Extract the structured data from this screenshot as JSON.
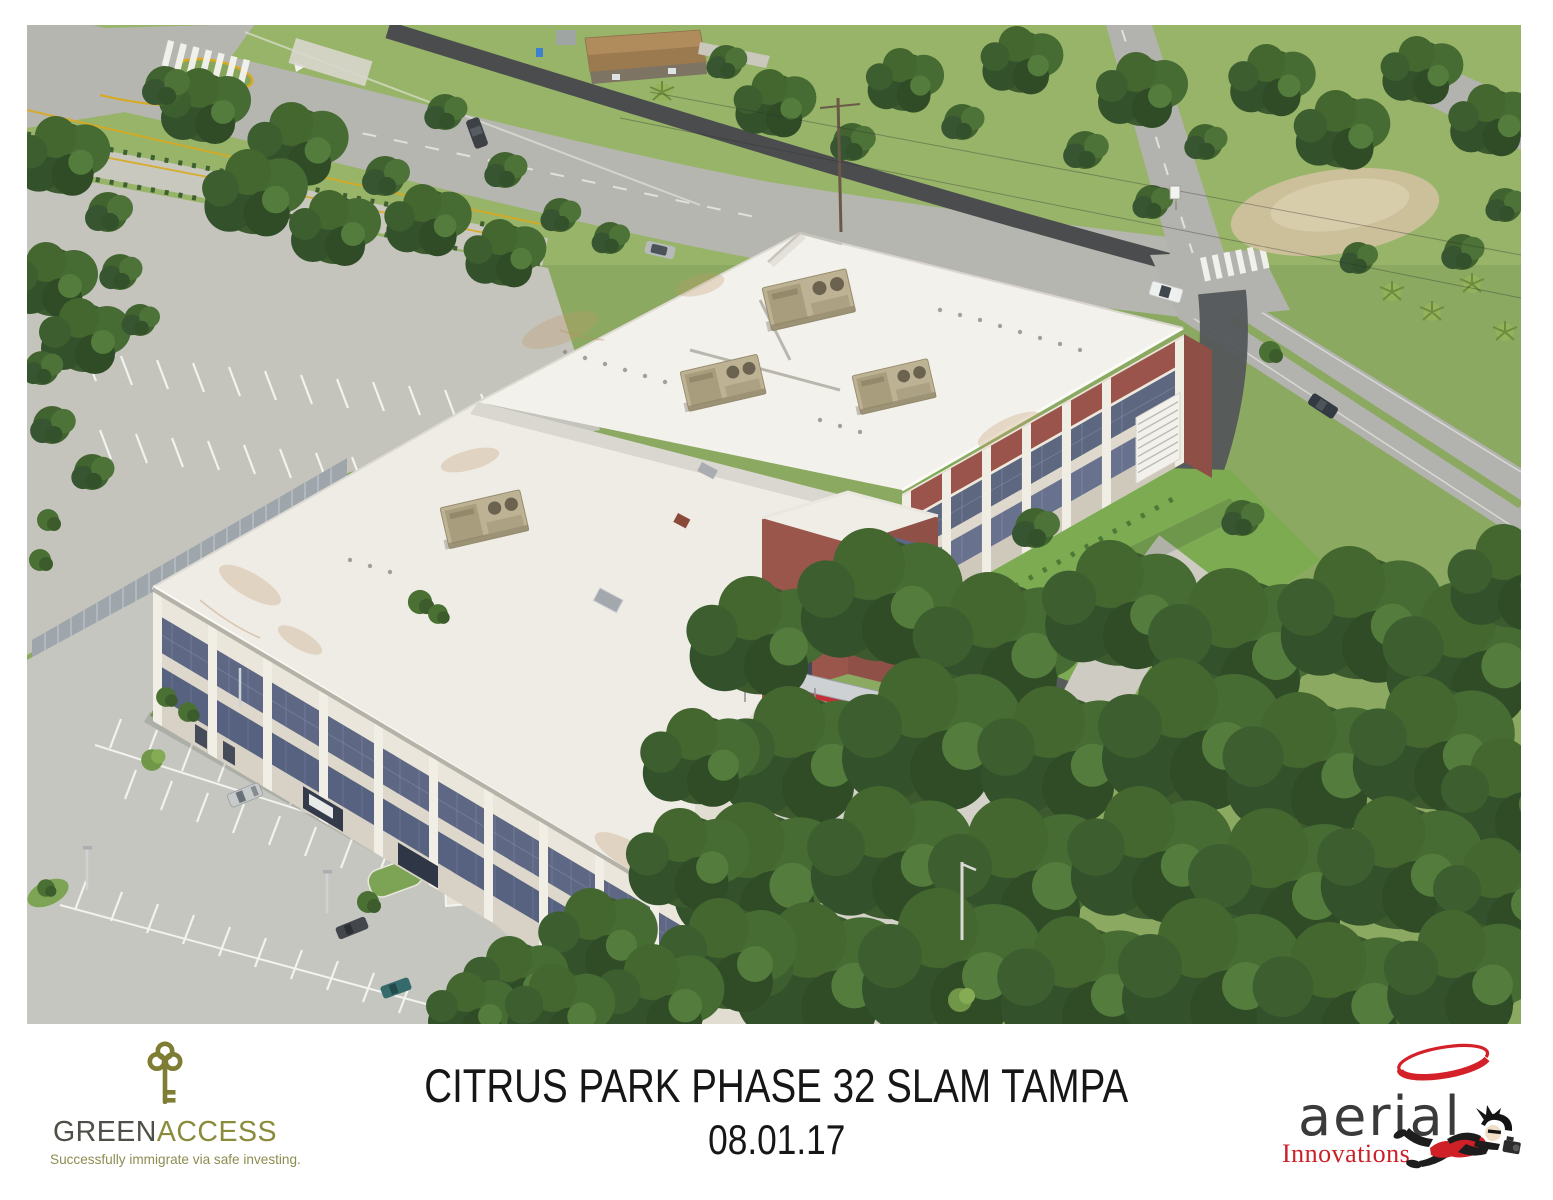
{
  "window": {
    "width": 1553,
    "height": 1200,
    "background": "#ffffff"
  },
  "photo": {
    "description": "Aerial photograph of a three-story office building with a white flat roof, tan rooftop HVAC units, cream, blue and maroon facade panels, striped parking lots, carport, roads with crosswalks and dense oak trees",
    "colors": {
      "roof_white": "#f3f1eb",
      "facade_cream": "#eae6db",
      "facade_blue": "#5e6884",
      "facade_maroon": "#9a544b",
      "hvac_tan": "#bdb293",
      "grass": "#8ca961",
      "tree_green": "#3c5a2e",
      "road_gray": "#b5b6b0",
      "asphalt_dark": "#4a4c4e",
      "parking_gray": "#c6c6c0",
      "paver_light": "#d3d1c8"
    }
  },
  "caption": {
    "title": "CITRUS PARK PHASE 32 SLAM TAMPA",
    "date": "08.01.17"
  },
  "logos": {
    "greenaccess": {
      "name_part_1": "GREEN",
      "name_part_2": "ACCESS",
      "tagline": "Successfully immigrate via safe investing.",
      "color_dark": "#4d5046",
      "color_olive": "#8a8c3b",
      "icon": "key-icon"
    },
    "aerial_innovations": {
      "name": "aerial",
      "subtitle": "Innovations",
      "color_text": "#3b3b3b",
      "color_red": "#cf2027",
      "icon": "swoosh-and-photographer"
    }
  }
}
